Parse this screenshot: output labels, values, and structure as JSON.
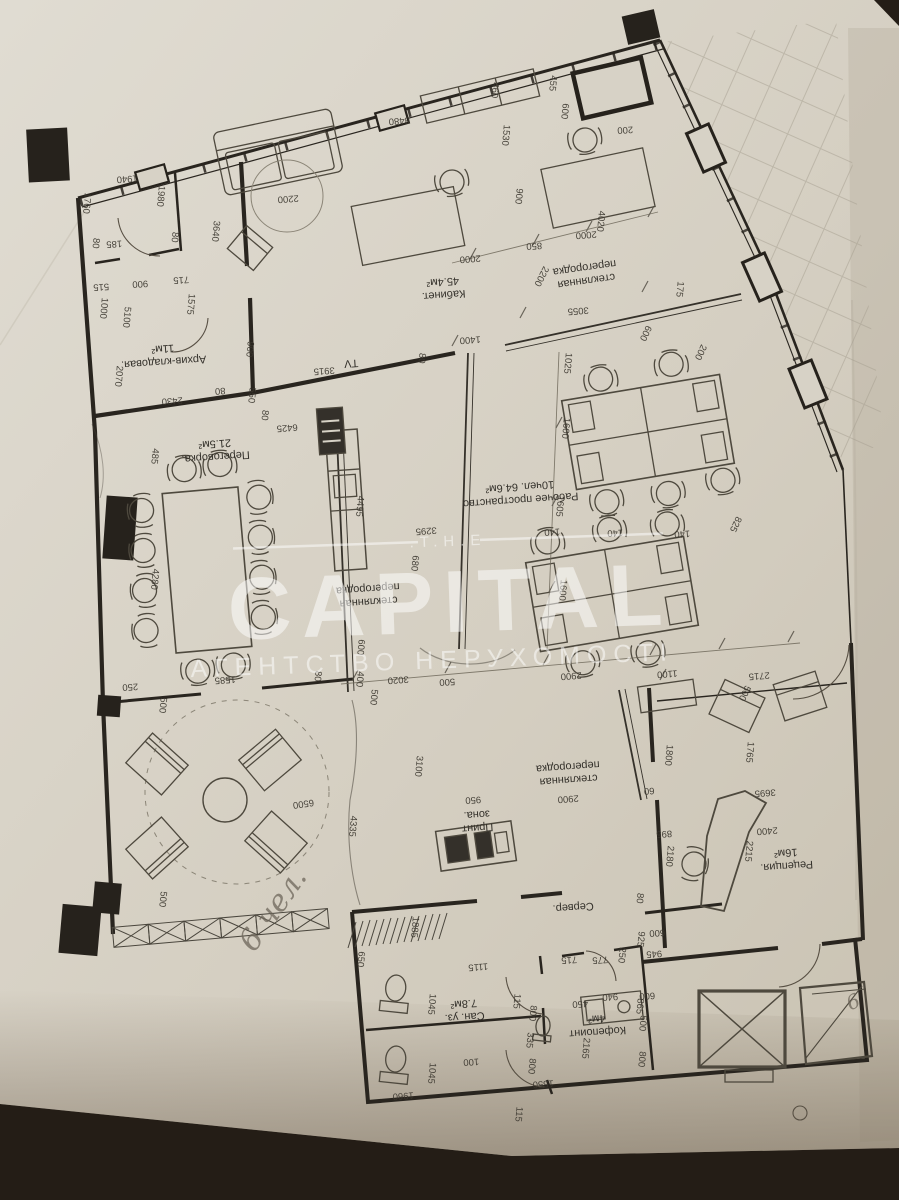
{
  "meta": {
    "kind": "photographed architectural floor plan",
    "language": "ru/uk"
  },
  "watermark": {
    "the": ".T.H.E",
    "capital": "CAPITAL",
    "agency": "АГЕНТСТВО НЕРУХОМОСТІ",
    "color": "#ffffff"
  },
  "plan": {
    "paper_color": "#d7d2c6",
    "line_color": "#29251f",
    "rooms": [
      {
        "id": "kabinet",
        "lines": [
          "Кабинет.",
          "45.4м²"
        ],
        "x": 443,
        "y": 285,
        "r": 176,
        "fs": 12
      },
      {
        "id": "glass-partition-1",
        "lines": [
          "стеклянная",
          "перегородка"
        ],
        "x": 585,
        "y": 271,
        "r": 172,
        "fs": 10.5
      },
      {
        "id": "arhiv",
        "lines": [
          "Архив-кладовая.",
          "11м²"
        ],
        "x": 163,
        "y": 352,
        "r": 176,
        "fs": 11
      },
      {
        "id": "peregovorka",
        "lines": [
          "Переговорка.",
          "21.5м²"
        ],
        "x": 215,
        "y": 447,
        "r": 176,
        "fs": 11.5
      },
      {
        "id": "workspace",
        "lines": [
          "Рабочее пространство",
          "10чел. 64.6м²"
        ],
        "x": 520,
        "y": 490,
        "r": 176,
        "fs": 11.5
      },
      {
        "id": "glass-partition-2",
        "lines": [
          "стеклянная",
          "перегородка"
        ],
        "x": 368,
        "y": 592,
        "r": 176,
        "fs": 10.5
      },
      {
        "id": "glass-partition-3",
        "lines": [
          "стеклянная",
          "перегородка"
        ],
        "x": 568,
        "y": 770,
        "r": 176,
        "fs": 10.5
      },
      {
        "id": "print-zone",
        "lines": [
          "Принт",
          "зона."
        ],
        "x": 477,
        "y": 818,
        "r": 176,
        "fs": 11
      },
      {
        "id": "server",
        "lines": [
          "Сервер."
        ],
        "x": 573,
        "y": 904,
        "r": 176,
        "fs": 11
      },
      {
        "id": "reception",
        "lines": [
          "Рецепция.",
          "16м²"
        ],
        "x": 786,
        "y": 856,
        "r": 176,
        "fs": 11
      },
      {
        "id": "coffee-point",
        "lines": [
          "Кофепоинт",
          "4м²"
        ],
        "x": 597,
        "y": 1022,
        "r": 176,
        "fs": 11
      },
      {
        "id": "san-uzel",
        "lines": [
          "Сан. уз.",
          "7.8м²"
        ],
        "x": 464,
        "y": 1007,
        "r": 176,
        "fs": 11
      },
      {
        "id": "tv",
        "lines": [
          "TV"
        ],
        "x": 351,
        "y": 360,
        "r": 176,
        "fs": 10
      }
    ],
    "dimensions": [
      {
        "t": "1760",
        "x": 84,
        "y": 203,
        "r": 95
      },
      {
        "t": "80",
        "x": 93,
        "y": 243,
        "r": 95
      },
      {
        "t": "185",
        "x": 114,
        "y": 241,
        "r": 176
      },
      {
        "t": "1940",
        "x": 127,
        "y": 176,
        "r": 176
      },
      {
        "t": "1980",
        "x": 158,
        "y": 196,
        "r": 95
      },
      {
        "t": "80",
        "x": 172,
        "y": 237,
        "r": 95
      },
      {
        "t": "3640",
        "x": 213,
        "y": 231,
        "r": 95
      },
      {
        "t": "2200",
        "x": 288,
        "y": 196,
        "r": 176
      },
      {
        "t": "8480",
        "x": 399,
        "y": 118,
        "r": 176
      },
      {
        "t": "460",
        "x": 492,
        "y": 90,
        "r": 95
      },
      {
        "t": "455",
        "x": 550,
        "y": 83,
        "r": 95
      },
      {
        "t": "1530",
        "x": 503,
        "y": 135,
        "r": 95
      },
      {
        "t": "600",
        "x": 562,
        "y": 111,
        "r": 95
      },
      {
        "t": "200",
        "x": 625,
        "y": 127,
        "r": 176
      },
      {
        "t": "4020",
        "x": 598,
        "y": 221,
        "r": 95
      },
      {
        "t": "900",
        "x": 516,
        "y": 196,
        "r": 95
      },
      {
        "t": "2000",
        "x": 470,
        "y": 256,
        "r": 176
      },
      {
        "t": "850",
        "x": 534,
        "y": 243,
        "r": 176
      },
      {
        "t": "2000",
        "x": 586,
        "y": 232,
        "r": 176
      },
      {
        "t": "515",
        "x": 101,
        "y": 284,
        "r": 176
      },
      {
        "t": "900",
        "x": 140,
        "y": 281,
        "r": 176
      },
      {
        "t": "715",
        "x": 181,
        "y": 277,
        "r": 176
      },
      {
        "t": "1000",
        "x": 101,
        "y": 308,
        "r": 95
      },
      {
        "t": "5100",
        "x": 124,
        "y": 317,
        "r": 95
      },
      {
        "t": "1575",
        "x": 188,
        "y": 304,
        "r": 95
      },
      {
        "t": "900",
        "x": 247,
        "y": 349,
        "r": 95
      },
      {
        "t": "2070",
        "x": 116,
        "y": 376,
        "r": 95
      },
      {
        "t": "2430",
        "x": 172,
        "y": 398,
        "r": 176
      },
      {
        "t": "80",
        "x": 220,
        "y": 388,
        "r": 176
      },
      {
        "t": "550",
        "x": 249,
        "y": 395,
        "r": 95
      },
      {
        "t": "1400",
        "x": 470,
        "y": 337,
        "r": 176
      },
      {
        "t": "3915",
        "x": 324,
        "y": 368,
        "r": 176
      },
      {
        "t": "80",
        "x": 419,
        "y": 358,
        "r": 95
      },
      {
        "t": "80",
        "x": 262,
        "y": 415,
        "r": 95
      },
      {
        "t": "6425",
        "x": 287,
        "y": 425,
        "r": 176
      },
      {
        "t": "485",
        "x": 152,
        "y": 456,
        "r": 95
      },
      {
        "t": "2200",
        "x": 539,
        "y": 275,
        "r": 117
      },
      {
        "t": "3055",
        "x": 578,
        "y": 308,
        "r": 176
      },
      {
        "t": "175",
        "x": 677,
        "y": 289,
        "r": 95
      },
      {
        "t": "600",
        "x": 643,
        "y": 332,
        "r": 115
      },
      {
        "t": "200",
        "x": 698,
        "y": 351,
        "r": 115
      },
      {
        "t": "1025",
        "x": 565,
        "y": 363,
        "r": 95
      },
      {
        "t": "1600",
        "x": 563,
        "y": 428,
        "r": 95
      },
      {
        "t": "1605",
        "x": 557,
        "y": 506,
        "r": 95
      },
      {
        "t": "1600",
        "x": 560,
        "y": 590,
        "r": 95
      },
      {
        "t": "825",
        "x": 733,
        "y": 523,
        "r": 115
      },
      {
        "t": "140",
        "x": 552,
        "y": 529,
        "r": 176
      },
      {
        "t": "140",
        "x": 615,
        "y": 530,
        "r": 176
      },
      {
        "t": "140",
        "x": 682,
        "y": 531,
        "r": 176
      },
      {
        "t": "4495",
        "x": 357,
        "y": 506,
        "r": 95
      },
      {
        "t": "3295",
        "x": 426,
        "y": 528,
        "r": 176
      },
      {
        "t": "680",
        "x": 412,
        "y": 563,
        "r": 95
      },
      {
        "t": "4280",
        "x": 152,
        "y": 579,
        "r": 95
      },
      {
        "t": "1585",
        "x": 225,
        "y": 677,
        "r": 176
      },
      {
        "t": "250",
        "x": 130,
        "y": 684,
        "r": 176
      },
      {
        "t": "500",
        "x": 160,
        "y": 705,
        "r": 95
      },
      {
        "t": "80",
        "x": 315,
        "y": 676,
        "r": 95
      },
      {
        "t": "600",
        "x": 358,
        "y": 647,
        "r": 95
      },
      {
        "t": "400",
        "x": 357,
        "y": 679,
        "r": 95
      },
      {
        "t": "500",
        "x": 371,
        "y": 697,
        "r": 95
      },
      {
        "t": "3020",
        "x": 398,
        "y": 677,
        "r": 176
      },
      {
        "t": "500",
        "x": 447,
        "y": 679,
        "r": 176
      },
      {
        "t": "2900",
        "x": 571,
        "y": 673,
        "r": 176
      },
      {
        "t": "1100",
        "x": 667,
        "y": 671,
        "r": 176
      },
      {
        "t": "2715",
        "x": 759,
        "y": 673,
        "r": 176
      },
      {
        "t": "3100",
        "x": 416,
        "y": 766,
        "r": 95
      },
      {
        "t": "950",
        "x": 473,
        "y": 797,
        "r": 176
      },
      {
        "t": "2900",
        "x": 568,
        "y": 796,
        "r": 176
      },
      {
        "t": "6500",
        "x": 303,
        "y": 801,
        "r": 172
      },
      {
        "t": "4335",
        "x": 350,
        "y": 826,
        "r": 95
      },
      {
        "t": "500",
        "x": 160,
        "y": 899,
        "r": 95
      },
      {
        "t": "1885",
        "x": 412,
        "y": 927,
        "r": 95
      },
      {
        "t": "650",
        "x": 358,
        "y": 959,
        "r": 95
      },
      {
        "t": "500",
        "x": 742,
        "y": 692,
        "r": 115
      },
      {
        "t": "1800",
        "x": 666,
        "y": 755,
        "r": 95
      },
      {
        "t": "60",
        "x": 649,
        "y": 788,
        "r": 176
      },
      {
        "t": "1765",
        "x": 747,
        "y": 752,
        "r": 95
      },
      {
        "t": "3695",
        "x": 765,
        "y": 790,
        "r": 176
      },
      {
        "t": "2400",
        "x": 767,
        "y": 828,
        "r": 176
      },
      {
        "t": "2215",
        "x": 746,
        "y": 851,
        "r": 95
      },
      {
        "t": "895",
        "x": 664,
        "y": 831,
        "r": 176
      },
      {
        "t": "2180",
        "x": 667,
        "y": 856,
        "r": 95
      },
      {
        "t": "80",
        "x": 637,
        "y": 898,
        "r": 95
      },
      {
        "t": "600",
        "x": 657,
        "y": 930,
        "r": 176
      },
      {
        "t": "925",
        "x": 638,
        "y": 939,
        "r": 95
      },
      {
        "t": "945",
        "x": 654,
        "y": 951,
        "r": 176
      },
      {
        "t": "250",
        "x": 619,
        "y": 955,
        "r": 95
      },
      {
        "t": "775",
        "x": 600,
        "y": 957,
        "r": 176
      },
      {
        "t": "715",
        "x": 569,
        "y": 957,
        "r": 176
      },
      {
        "t": "1115",
        "x": 478,
        "y": 964,
        "r": 176
      },
      {
        "t": "115",
        "x": 514,
        "y": 1001,
        "r": 95
      },
      {
        "t": "800",
        "x": 530,
        "y": 1013,
        "r": 95
      },
      {
        "t": "335",
        "x": 527,
        "y": 1040,
        "r": 95
      },
      {
        "t": "800",
        "x": 529,
        "y": 1066,
        "r": 95
      },
      {
        "t": "1550",
        "x": 543,
        "y": 1081,
        "r": 176
      },
      {
        "t": "450",
        "x": 580,
        "y": 1001,
        "r": 176
      },
      {
        "t": "940",
        "x": 610,
        "y": 994,
        "r": 176
      },
      {
        "t": "2165",
        "x": 583,
        "y": 1048,
        "r": 95
      },
      {
        "t": "600",
        "x": 647,
        "y": 993,
        "r": 176
      },
      {
        "t": "865",
        "x": 637,
        "y": 1006,
        "r": 95
      },
      {
        "t": "500",
        "x": 640,
        "y": 1023,
        "r": 95
      },
      {
        "t": "800",
        "x": 639,
        "y": 1059,
        "r": 95
      },
      {
        "t": "1045",
        "x": 429,
        "y": 1004,
        "r": 95
      },
      {
        "t": "1045",
        "x": 429,
        "y": 1073,
        "r": 95
      },
      {
        "t": "100",
        "x": 471,
        "y": 1059,
        "r": 176
      },
      {
        "t": "1960",
        "x": 403,
        "y": 1093,
        "r": 176
      },
      {
        "t": "115",
        "x": 516,
        "y": 1114,
        "r": 95
      }
    ],
    "handwritten": [
      {
        "t": "6 чел.",
        "x": 281,
        "y": 915,
        "r": -55,
        "fs": 30
      },
      {
        "t": "6",
        "x": 856,
        "y": 1008,
        "r": -25,
        "fs": 20
      }
    ]
  }
}
